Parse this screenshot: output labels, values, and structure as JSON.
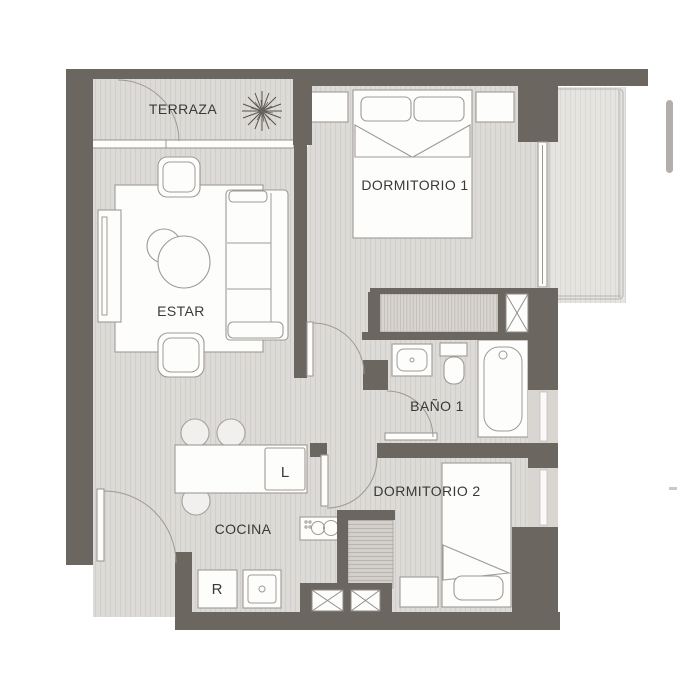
{
  "plan": {
    "title": "apartment-floor-plan",
    "rooms": {
      "terraza": {
        "label": "TERRAZA"
      },
      "estar": {
        "label": "ESTAR"
      },
      "dormitorio1": {
        "label": "DORMITORIO 1"
      },
      "bano1": {
        "label": "BAÑO 1"
      },
      "cocina": {
        "label": "COCINA"
      },
      "dormitorio2": {
        "label": "DORMITORIO 2"
      }
    },
    "appliances": {
      "washer_label": "L",
      "fridge_label": "R"
    },
    "icons": [
      "plant-icon",
      "duct-x-icon"
    ],
    "colors": {
      "wall": "#6C6661",
      "floor": "#DDDBD8",
      "floor_stripe": "#D2CFCB",
      "balcony": "#E6E4E1",
      "balcony_stripe": "#DBD8D4",
      "furniture_stroke": "#9E9A96",
      "label_text": "#3B3936",
      "scrollbar": "#B3AEAB"
    }
  }
}
